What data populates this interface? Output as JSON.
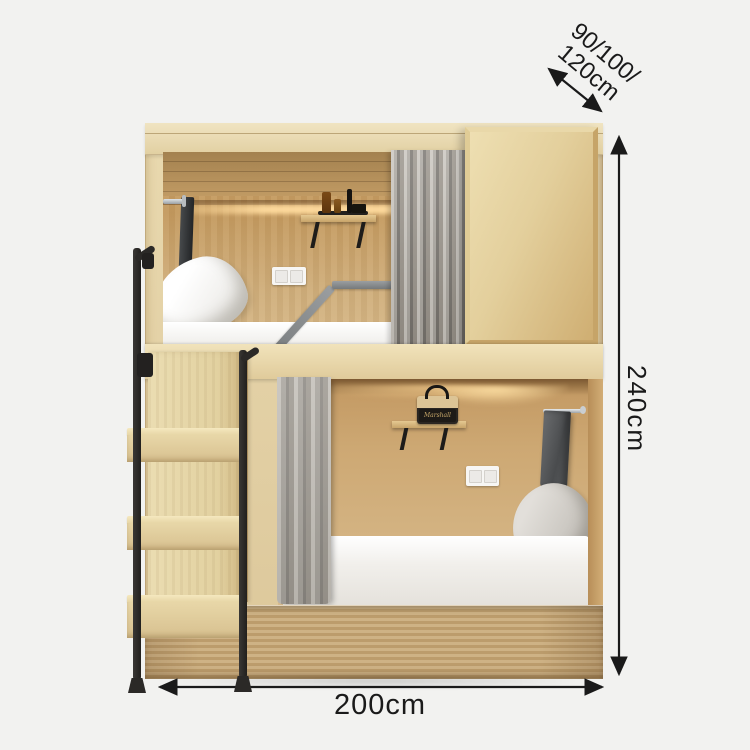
{
  "scene": {
    "background_color": "#f2f2f0",
    "subject": "wooden loft bunk bed with staircase, curtains, shelves and sliding cabinet"
  },
  "annotations": {
    "depth_line1": "90/100/",
    "depth_line2": "120cm",
    "height": "240cm",
    "width": "200cm",
    "arrow_style": "double-headed-arrow",
    "text_color": "#1a1a1a"
  },
  "bed": {
    "speaker_brand": "Marshall"
  },
  "colors": {
    "wood_light": "#e9d9af",
    "wood_mid": "#cfa973",
    "wood_interior": "#c49a5f",
    "curtain_gray": "#a5a19a",
    "metal_black": "#2b2927",
    "guard_rail_gray": "#8d9092",
    "mattress_white": "#f4f3f0",
    "led_glow": "#ffd89a",
    "pillow_gray": "#c3bfb8"
  }
}
